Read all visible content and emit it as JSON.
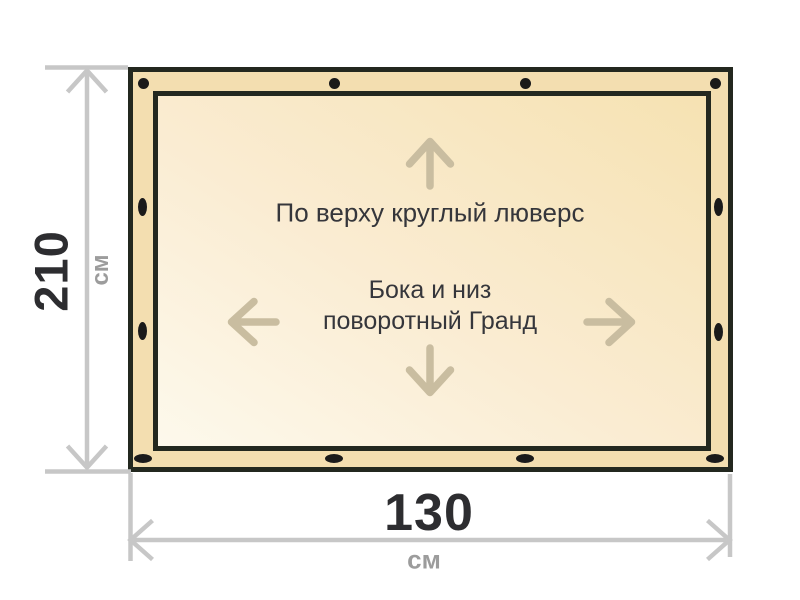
{
  "diagram": {
    "notes": {
      "top": "По верху круглый люверс",
      "middle_line1": "Бока и низ",
      "middle_line2": "поворотный Гранд"
    },
    "dimensions": {
      "height": {
        "value": "210",
        "unit": "см"
      },
      "width": {
        "value": "130",
        "unit": "см"
      }
    },
    "grommets": {
      "top_edge_count": 4,
      "bottom_edge_count": 4,
      "left_edge_count": 2,
      "right_edge_count": 2
    },
    "colors": {
      "page_background": "#ffffff",
      "tarp_edge_fill": "#f3deb0",
      "tarp_inner_light": "#fdf9ec",
      "tarp_inner_dark": "#f6e2b2",
      "outline": "#23281f",
      "grommet": "#1a1a1a",
      "dimension_line": "#c7c7c7",
      "dimension_value_text": "#2d2d30",
      "dimension_unit_text": "#9c9c9c",
      "note_text": "#35363b",
      "direction_arrow": "#c9bda0"
    }
  }
}
